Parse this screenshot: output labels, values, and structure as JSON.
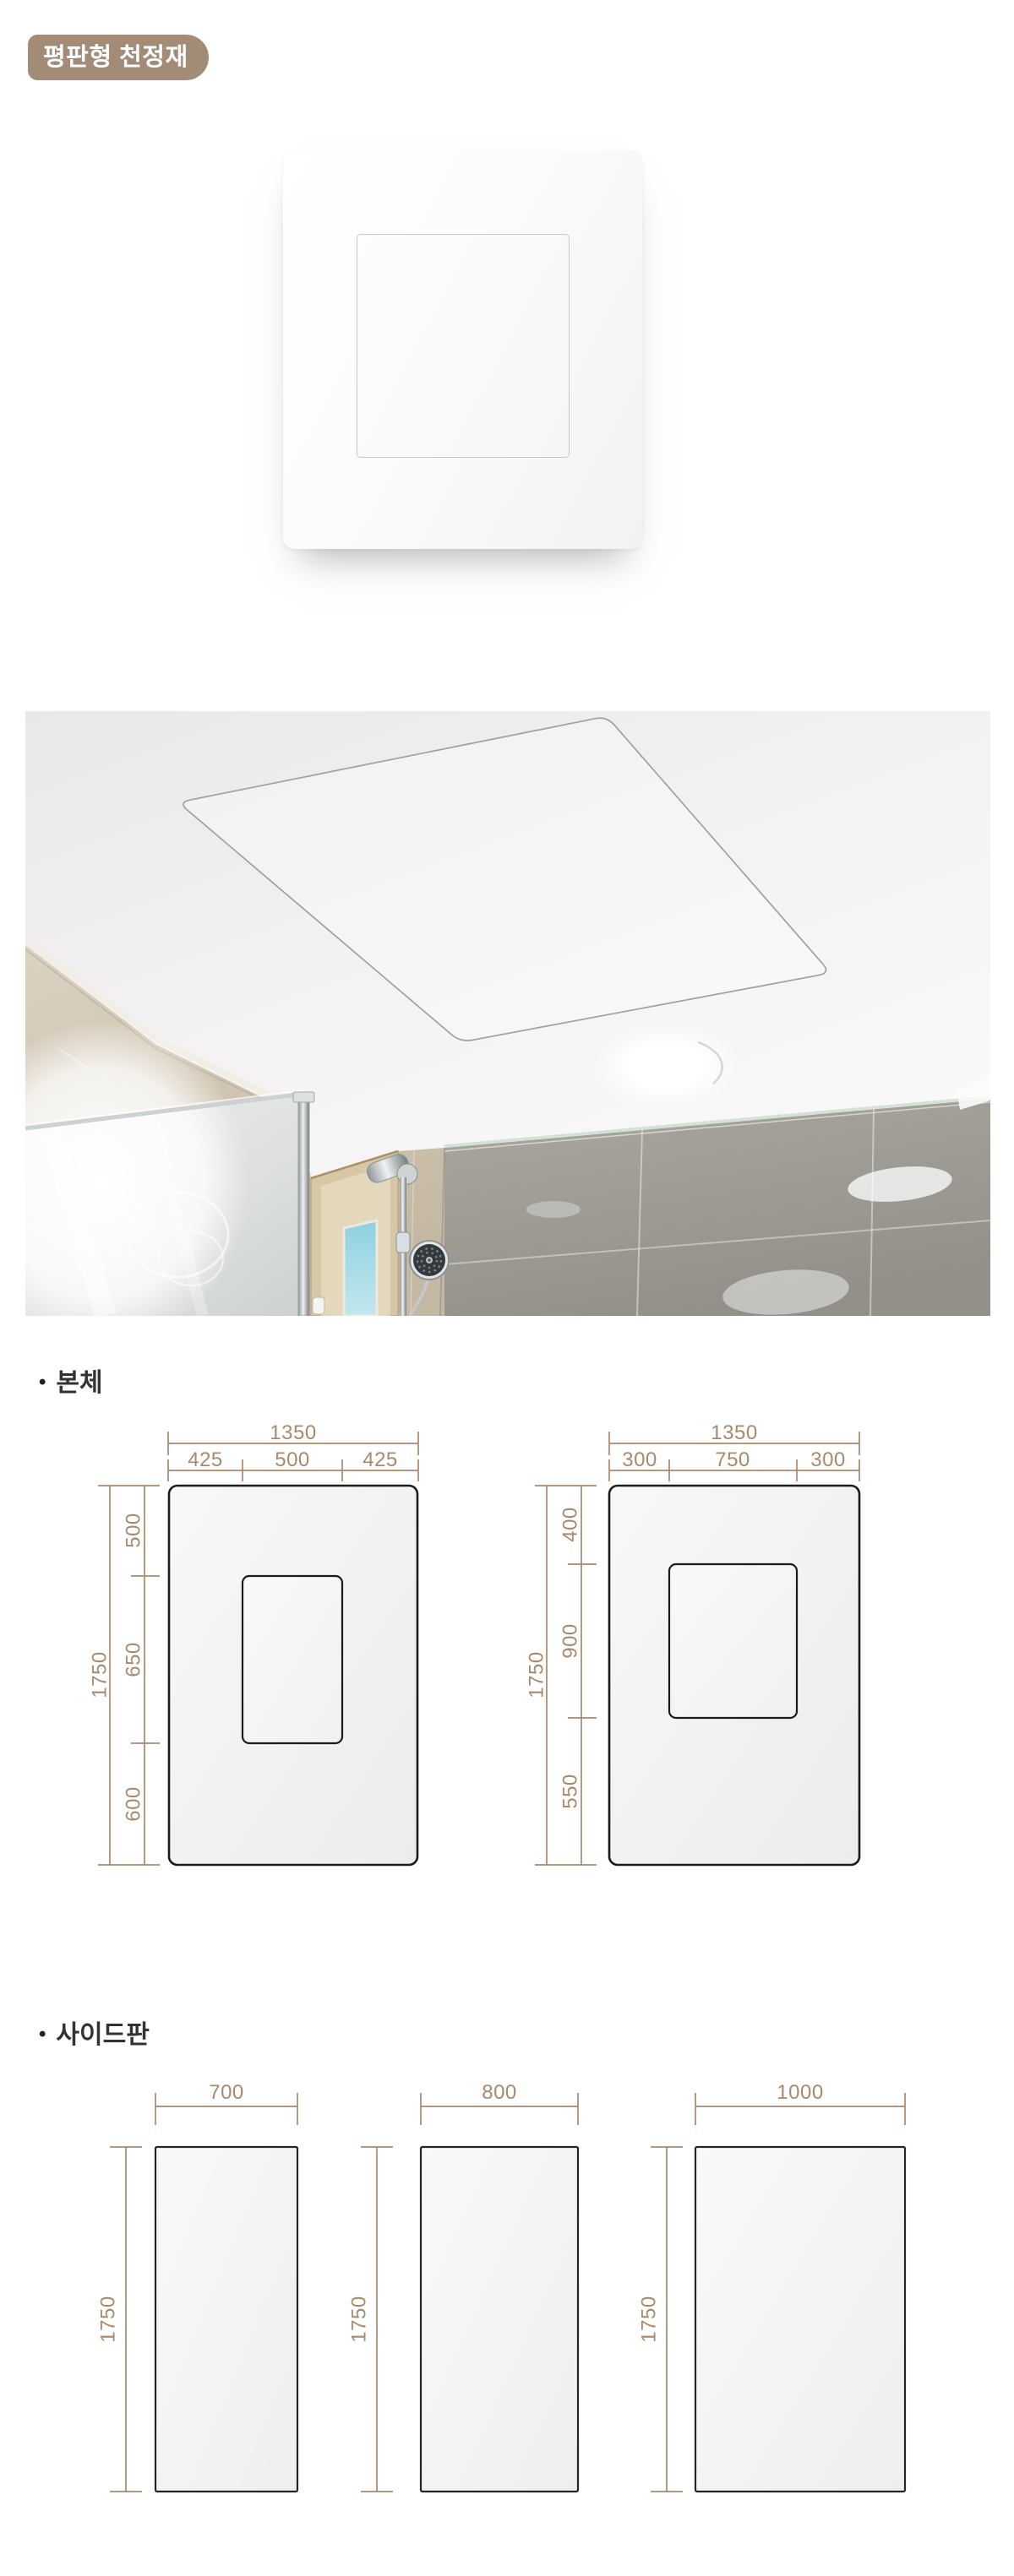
{
  "badge": {
    "label": "평판형 천정재",
    "bg_color": "#a38c77",
    "text_color": "#ffffff"
  },
  "sections": {
    "body": {
      "bullet": "•",
      "label": "본체"
    },
    "side": {
      "bullet": "•",
      "label": "사이드판"
    }
  },
  "diagrams": {
    "dimension_color": "#a8896c",
    "outline_color": "#1b1b1b",
    "body_panels": [
      {
        "overall_width": "1350",
        "width_segments": [
          "425",
          "500",
          "425"
        ],
        "overall_height": "1750",
        "height_segments": [
          "500",
          "650",
          "600"
        ]
      },
      {
        "overall_width": "1350",
        "width_segments": [
          "300",
          "750",
          "300"
        ],
        "overall_height": "1750",
        "height_segments": [
          "400",
          "900",
          "550"
        ]
      }
    ],
    "side_panels": [
      {
        "width": "700",
        "height": "1750"
      },
      {
        "width": "800",
        "height": "1750"
      },
      {
        "width": "1000",
        "height": "1750"
      }
    ]
  }
}
